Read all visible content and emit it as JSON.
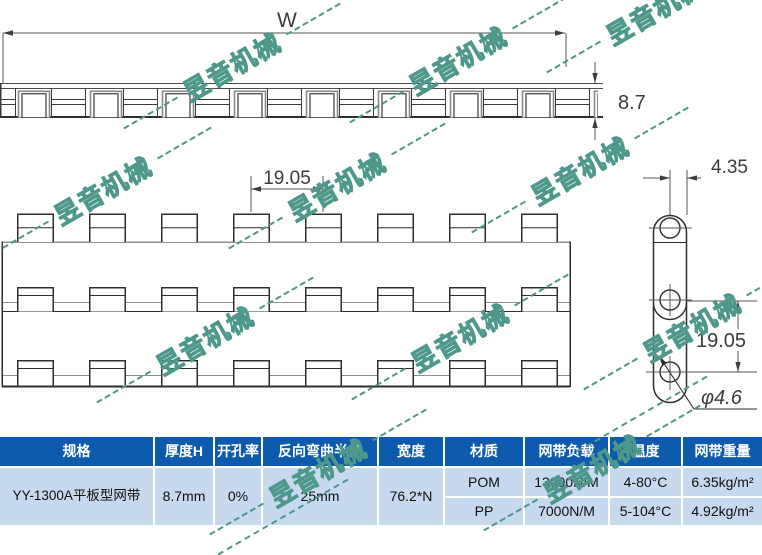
{
  "watermark": {
    "text": "昱音机械",
    "color": "#4e988b"
  },
  "drawing": {
    "top_view": {
      "width_label": "W",
      "thickness_label": "8.7"
    },
    "plan_view": {
      "pitch_label": "19.05"
    },
    "link_view": {
      "edge_label": "4.35",
      "pitch_label": "19.05",
      "hole_label": "φ4.6"
    }
  },
  "colors": {
    "table_header_bg": "#0e5bad",
    "table_body_bg": "#c6d9ee",
    "watermark": "#4e988b",
    "drawing_line": "#2e2e2e"
  },
  "table": {
    "columns": [
      "规格",
      "厚度H",
      "开孔率",
      "反向弯曲半径",
      "宽度",
      "材质",
      "网带负载",
      "温度",
      "网带重量"
    ],
    "row_merged": {
      "spec": "YY-1300A平板型网带",
      "thickness": "8.7mm",
      "open_ratio": "0%",
      "bend_radius": "25mm",
      "width": "76.2*N"
    },
    "rows": [
      {
        "material": "POM",
        "load": "13000N/M",
        "temperature": "4-80°C",
        "weight": "6.35kg/m²"
      },
      {
        "material": "PP",
        "load": "7000N/M",
        "temperature": "5-104°C",
        "weight": "4.92kg/m²"
      }
    ]
  }
}
